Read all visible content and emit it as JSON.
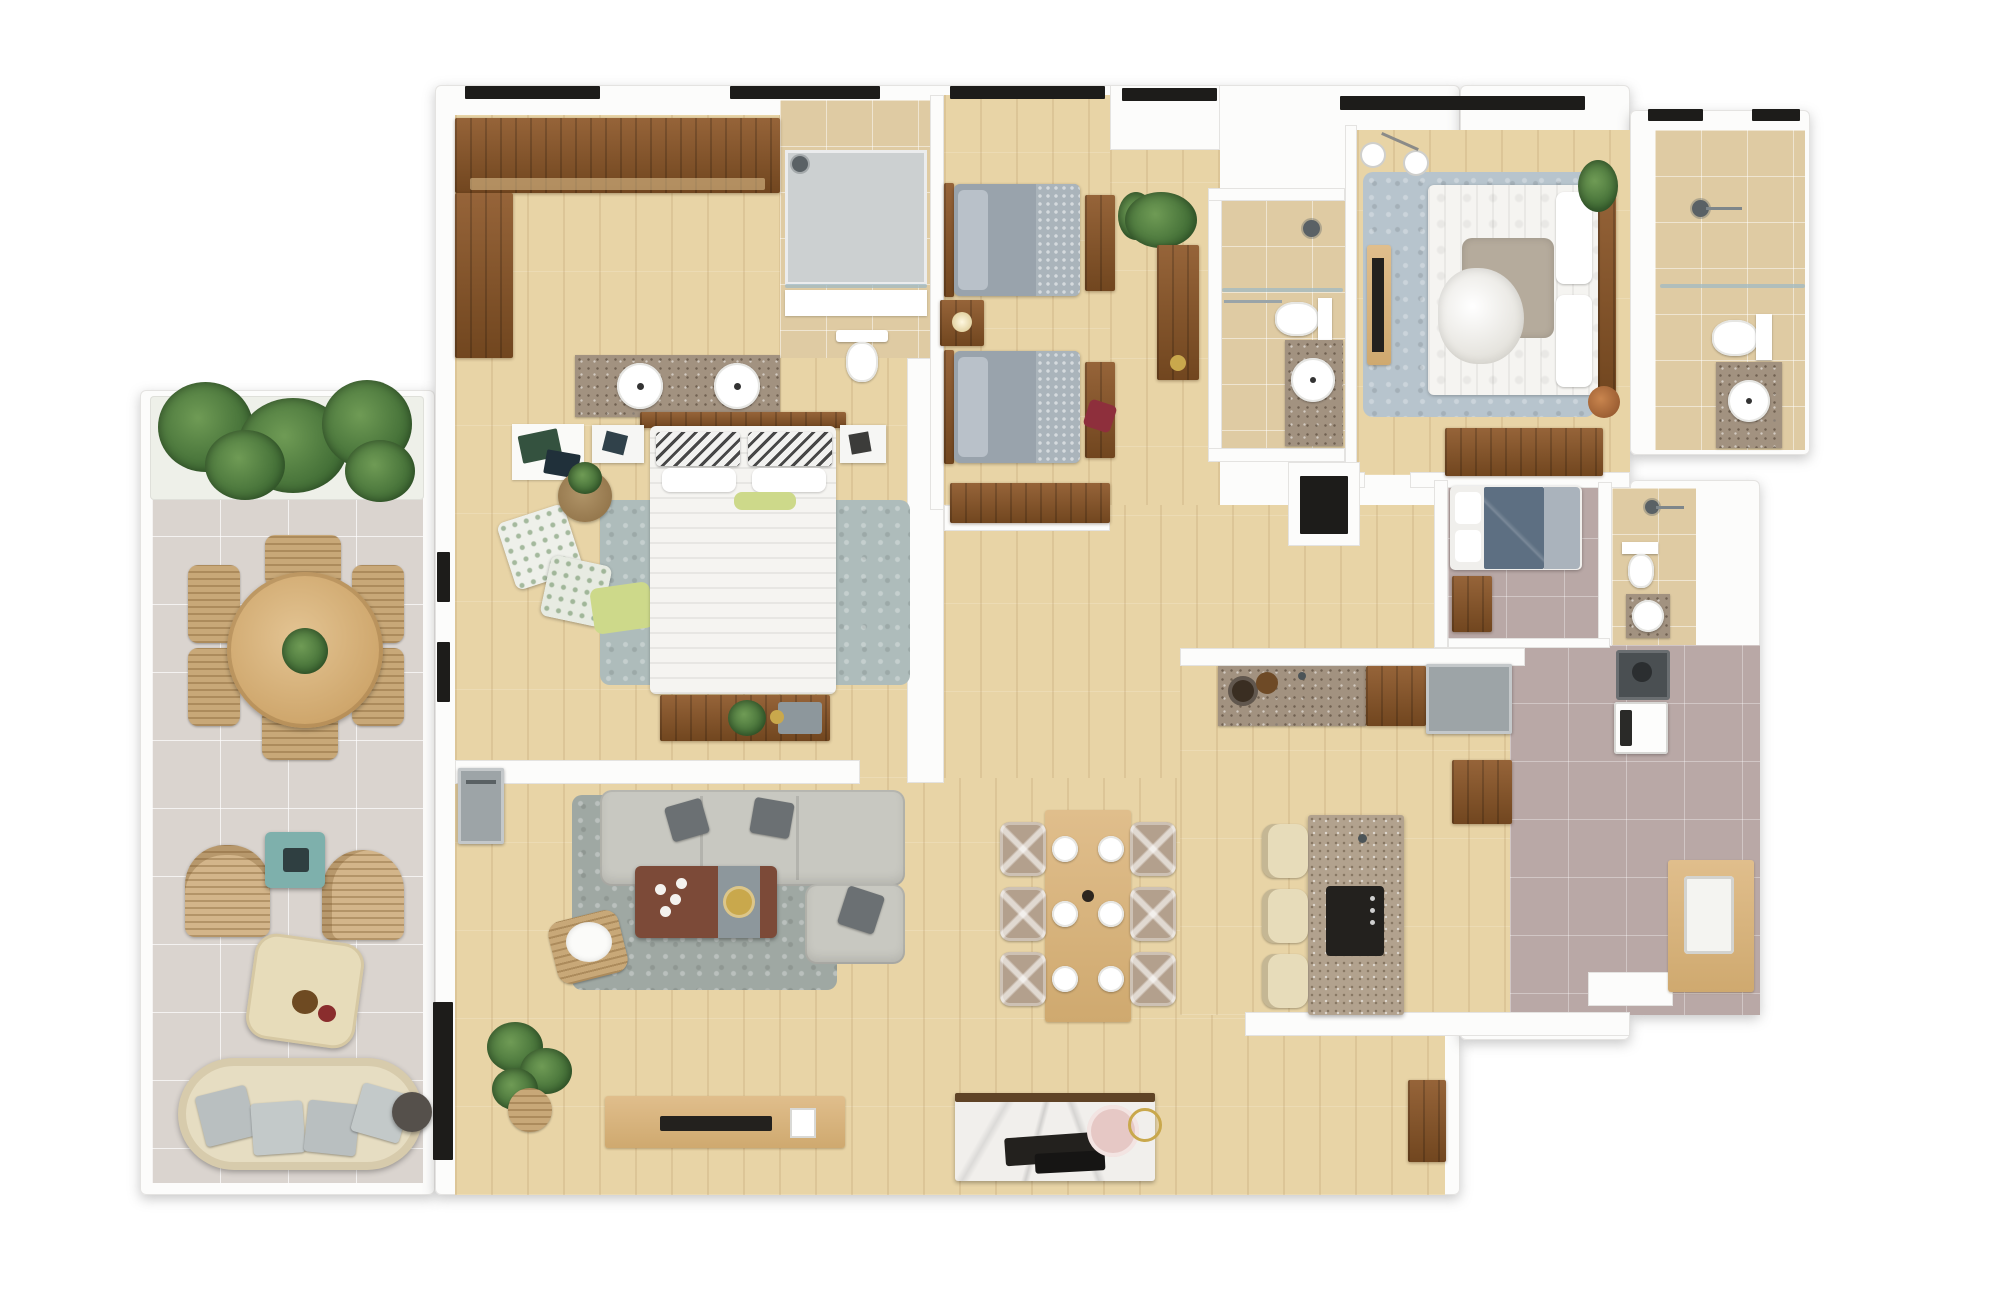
{
  "scene": {
    "type": "3d-floor-plan-top-down-render",
    "description": "Photoreal top-down 3D floor plan of a large apartment: left open balcony with round dining set and lounge, walk-in closet and master suite with double-sink vanity, living room with L-sofa, open dining area with six-seat table, kitchen with island and three stools, twin-bed children's room, second en-suite bedroom, maid's room with private bath, service/laundry wing with washer and dryer, and three additional bathrooms.",
    "text_labels": []
  },
  "palette": {
    "wall": "#fcfcfb",
    "wall_edge": "#e4e3e1",
    "wood": "#e8d4a6",
    "wood_line": "rgba(150,108,58,0.14)",
    "balcony_tile": "#dad4cf",
    "beige_tile": "#dfcba3",
    "mauve_tile": "#b9a8a6",
    "dark_wood_hi": "#966439",
    "dark_wood_lo": "#71461f",
    "light_wood": "#d8b683",
    "granite": "#a29280",
    "island_granite": "#b2a28e",
    "shower_gray": "#ccd0d1",
    "bed_gray": "#99a3ac",
    "bed_gray_tex": "#aab4bb",
    "bedding_white": "#f5f4f1",
    "rug_master": "#aebcbb",
    "rug_living": "#9fa8a3",
    "rug_blue": "#b7c4cd",
    "sofa_gray": "#c8c8c1",
    "pillow_dark": "#6b7073",
    "table_brown": "#7c4a38",
    "runner_gray": "#8d979c",
    "gold": "#c9a84c",
    "teal": "#7eb0ac",
    "wicker": "#c8a878",
    "cream": "#e7dcba",
    "plant_dark": "#3f6b34",
    "plant_mid": "#6f9b55",
    "navy_bed": "#5d6f82",
    "appliance_gray": "#9da4a7",
    "black": "#23211e",
    "marble": "#f1efec",
    "pink": "#e6c8c5",
    "red_pillow": "#8e2f3c",
    "window_dark": "#1d1c1a",
    "green_pillow": "#cdd98a"
  },
  "rooms": [
    {
      "id": "balcony",
      "name": "Balcony / Terrace",
      "furniture": [
        "planter-hedge",
        "round-dining-table",
        "6 wicker chairs",
        "2 wicker armchairs",
        "teal side table",
        "pouf",
        "curved outdoor sofa",
        "round side table"
      ]
    },
    {
      "id": "walk-in-closet",
      "name": "Walk-in Closet",
      "furniture": [
        "L-shaped wardrobe"
      ]
    },
    {
      "id": "master-bathroom",
      "name": "Master Bathroom",
      "furniture": [
        "shower",
        "toilet",
        "double-sink granite vanity"
      ]
    },
    {
      "id": "master-bedroom",
      "name": "Master Bedroom",
      "furniture": [
        "double bed with chevron pillows",
        "2 nightstands",
        "area rug",
        "foot bench with plant",
        "floor pillows",
        "basket plant",
        "dresser mat"
      ]
    },
    {
      "id": "living-room",
      "name": "Living Room",
      "furniture": [
        "L-shaped sectional sofa",
        "gray rug",
        "coffee table with runner",
        "storage basket",
        "floor plant",
        "TV console with TV"
      ]
    },
    {
      "id": "dining-area",
      "name": "Dining Area",
      "furniture": [
        "rectangular table",
        "6 upholstered chairs",
        "6 place settings",
        "marble buffet with trays"
      ]
    },
    {
      "id": "kitchen",
      "name": "Kitchen",
      "furniture": [
        "granite counter with sink and bowls",
        "wood cabinet",
        "gray appliance",
        "island with cooktop",
        "3 bar stools"
      ]
    },
    {
      "id": "twin-bedroom",
      "name": "Twin Bedroom",
      "furniture": [
        "2 single gray beds",
        "shared nightstand with lamp",
        "2 foot benches",
        "red pillow",
        "plant",
        "low console"
      ]
    },
    {
      "id": "hallway",
      "name": "Hallway",
      "furniture": [
        "tall console",
        "plant"
      ]
    },
    {
      "id": "bathroom-2",
      "name": "Bathroom 2",
      "furniture": [
        "shower",
        "toilet",
        "granite vanity with round sink"
      ]
    },
    {
      "id": "bedroom-3",
      "name": "Bedroom 3 (En-suite)",
      "furniture": [
        "double bed",
        "blue rug",
        "wall TV panel",
        "wardrobe",
        "ceiling lights",
        "plant",
        "copper pot"
      ]
    },
    {
      "id": "bathroom-3",
      "name": "En-suite Bathroom 3",
      "furniture": [
        "shower",
        "toilet",
        "granite vanity with round sink"
      ]
    },
    {
      "id": "maid-room",
      "name": "Maid's Room",
      "furniture": [
        "single bed with navy bedding",
        "nightstand"
      ]
    },
    {
      "id": "bathroom-4",
      "name": "Maid's Bathroom",
      "furniture": [
        "shower",
        "toilet",
        "small sink"
      ]
    },
    {
      "id": "service-area",
      "name": "Service / Laundry",
      "furniture": [
        "dark appliance",
        "washing machine",
        "laundry counter with basin",
        "storage cabinet"
      ]
    },
    {
      "id": "shaft",
      "name": "Duct Shaft",
      "furniture": []
    }
  ]
}
